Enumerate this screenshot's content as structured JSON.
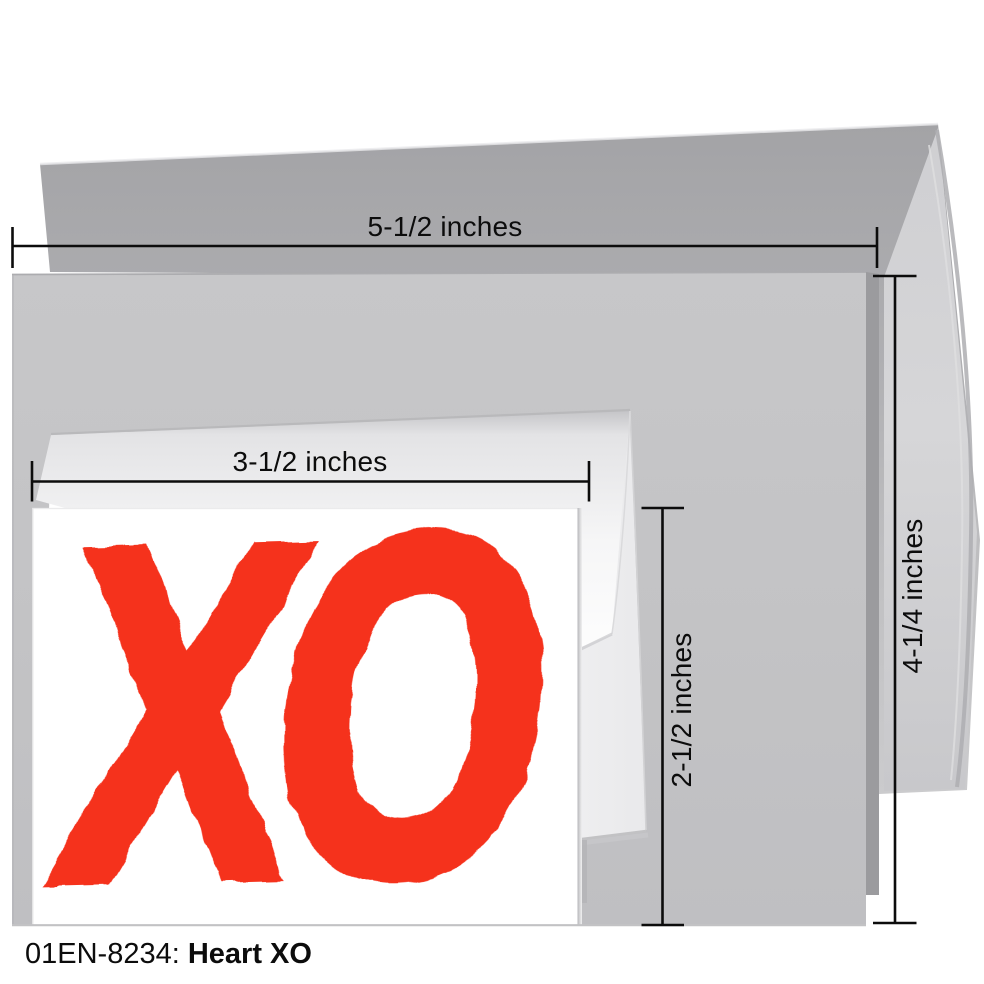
{
  "product": {
    "code": "01EN-8234:",
    "name": "Heart XO",
    "artwork_text": "XO"
  },
  "annotations": {
    "envelope_width": "5-1/2 inches",
    "envelope_height": "4-1/4 inches",
    "card_width": "3-1/2 inches",
    "card_height": "2-1/2 inches"
  },
  "colors": {
    "artwork_red": "#f5301d",
    "envelope_gray": "#c4c4c6",
    "annotation_black": "#0c0c0c",
    "card_white": "#ffffff"
  }
}
